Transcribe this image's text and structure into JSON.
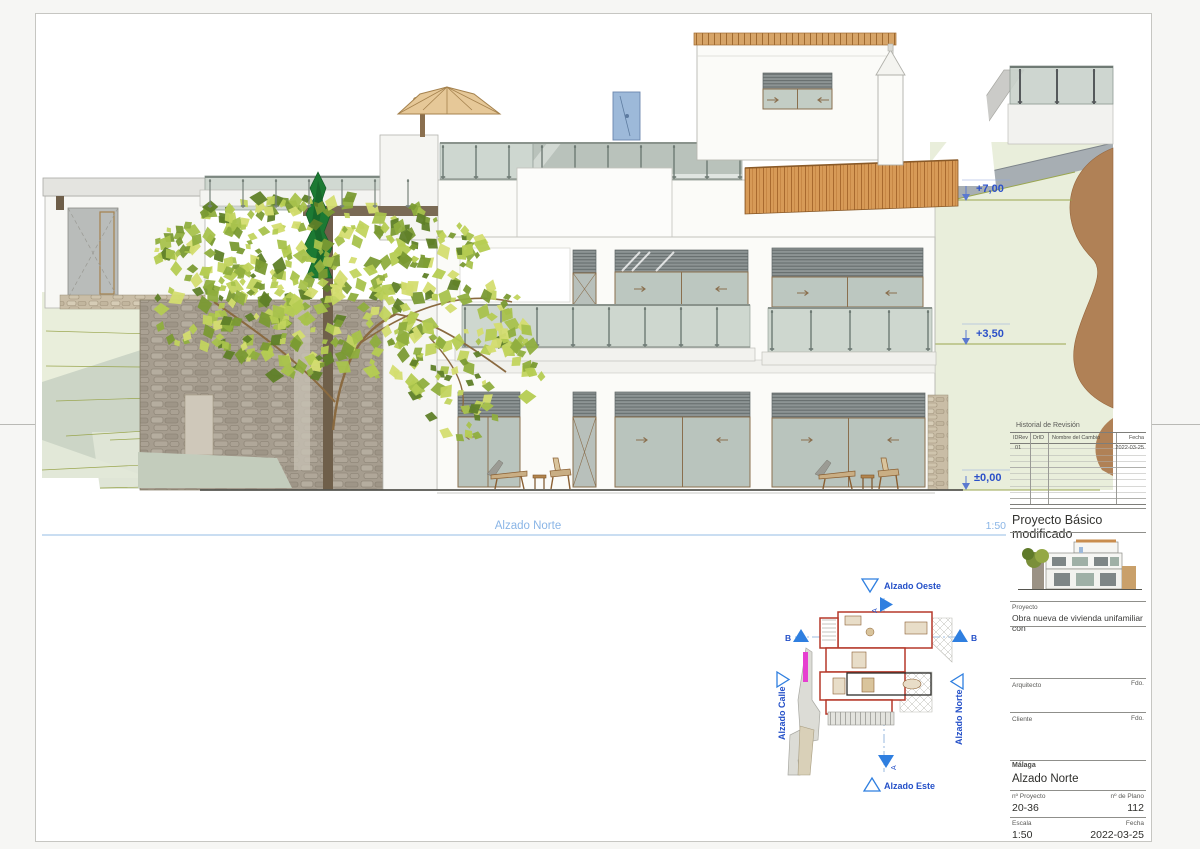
{
  "sheet": {
    "elevation": {
      "caption": "Alzado Norte",
      "scale": "1:50",
      "levels": {
        "l1": "+7,00",
        "l2": "+3,50",
        "l3": "±0,00"
      }
    },
    "site_plan": {
      "west": "Alzado Oeste",
      "east": "Alzado Este",
      "north": "Alzado Norte",
      "street": "Alzado Calle",
      "section_a": "A",
      "section_b": "B"
    },
    "title_block": {
      "revision": {
        "title": "Historial de Revisión",
        "headers": [
          "IDRev",
          "DrID",
          "Nombre del Cambio",
          "Fecha"
        ],
        "row": {
          "id": "01",
          "date": "2022-03-25"
        }
      },
      "doc_title": "Proyecto Básico modificado",
      "project_label": "Proyecto",
      "project_value": "Obra nueva de vivienda unifamiliar con",
      "architect_label": "Arquitecto",
      "architect_sign": "Fdo.",
      "client_label": "Cliente",
      "client_sign": "Fdo.",
      "location": "Málaga",
      "drawing_name": "Alzado Norte",
      "project_no_label": "nº Proyecto",
      "project_no": "20-36",
      "plan_no_label": "nº de Plano",
      "plan_no": "112",
      "scale_label": "Escala",
      "scale": "1:50",
      "date_label": "Fecha",
      "date": "2022-03-25"
    },
    "colors": {
      "annotation_blue": "#2b50c8",
      "caption_blue": "#8ab5e6",
      "terrain_green": "#e9eedb",
      "stone": "#a79e90",
      "tile": "#d0914f",
      "rock": "#b08156"
    }
  }
}
